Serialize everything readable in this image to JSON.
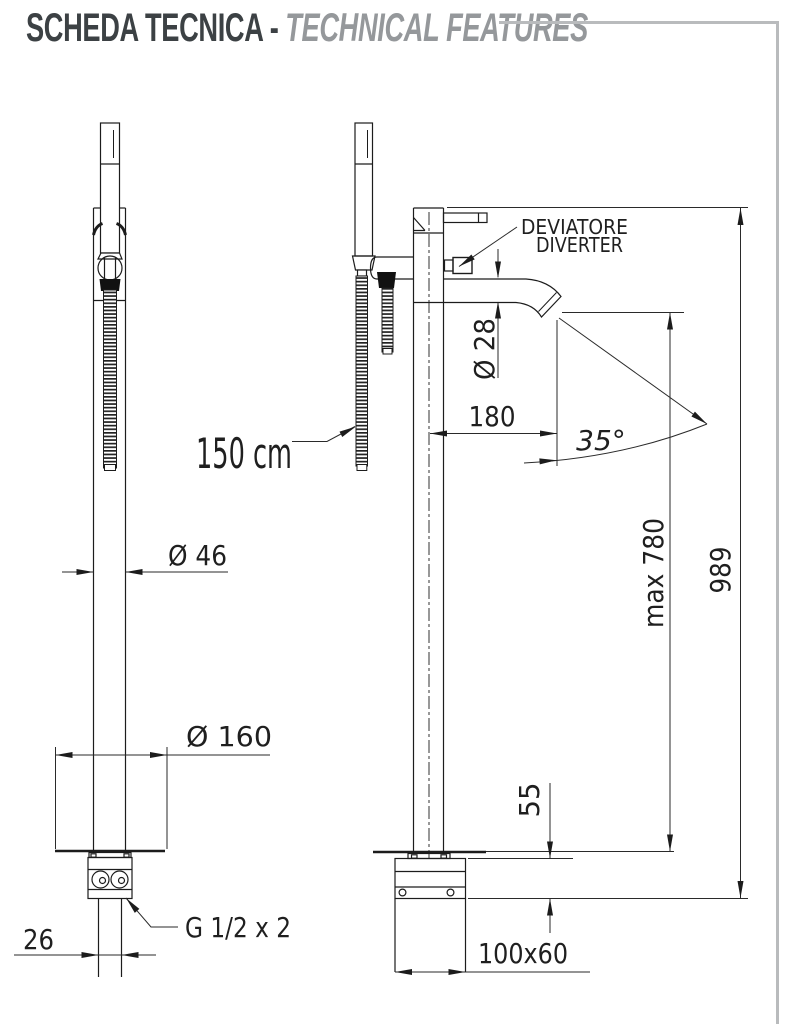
{
  "header": {
    "title_it": "SCHEDA TECNICA -",
    "title_en": "TECHNICAL FEATURES"
  },
  "colors": {
    "ink": "#1c1c1c",
    "title_dark": "#3c4144",
    "title_gray": "#95989b",
    "rule_gray": "#b9bbbd"
  },
  "dimensions": {
    "hose_length": "150 cm",
    "column_diameter": "Ø 46",
    "base_plate_diameter": "Ø 160",
    "supply_pipe_width": "26",
    "supply_connection": "G 1/2 x 2",
    "spout_diameter": "Ø 28",
    "spout_reach": "180",
    "spout_angle": "35°",
    "spout_max_height": "max 780",
    "total_height": "989",
    "underfloor_box_height": "55",
    "underfloor_box_footprint": "100x60"
  },
  "callouts": {
    "diverter_it": "DEVIATORE",
    "diverter_en": "DIVERTER"
  }
}
